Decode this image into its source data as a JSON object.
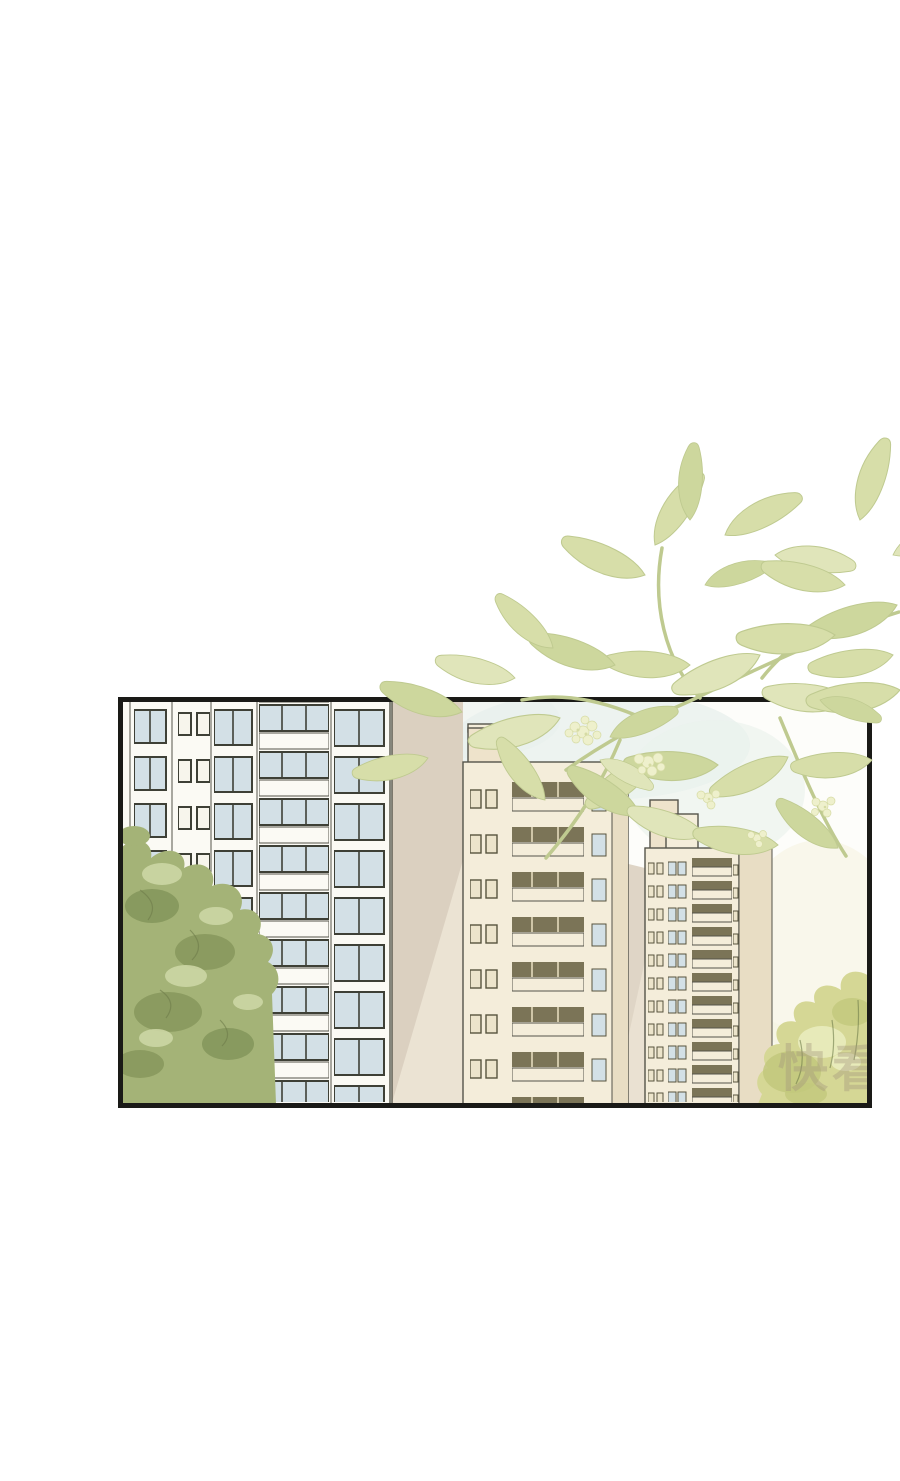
{
  "scene": {
    "type": "comic-panel",
    "watermark": "快看"
  },
  "colors": {
    "page_bg": "#ffffff",
    "panel_border": "#1a1a17",
    "sky": "#fdfdfa",
    "sky_tint": "#e2ece8",
    "sky_tint_warm": "#f4f1dc",
    "outline": "#55544a",
    "wall_white": "#fbfaf4",
    "wall_cream": "#f4edda",
    "wall_cream_dark": "#e8ddc4",
    "wall_tan": "#dbd0c0",
    "wall_tan_light": "#ece4d5",
    "penthouse": "#eee3cb",
    "window_blue": "#d3e0e6",
    "window_white": "#f7f5ec",
    "window_frame": "#3e4036",
    "window_cream": "#ece4cb",
    "window_cream_frame": "#57543e",
    "band_dark": "#7b7457",
    "railing_tan": "#c9b98e",
    "railing_brown": "#8a7b54",
    "railing_slat_dark": "#5c5c44",
    "railing_base_dark": "#a9a685",
    "leaf": "#d7dea9",
    "leaf_b": "#cdd79d",
    "leaf_c": "#e0e5ba",
    "leaf_outline": "#bfca90",
    "flower": "#eef0cc",
    "flower_edge": "#d6dba4",
    "bush": "#a4b377",
    "bush_dark": "#84955a",
    "bush_light": "#ccd6a4",
    "bush_edge": "#6e7c49",
    "foliage": "#d5d795",
    "foliage_dark": "#c2c87c",
    "foliage_light": "#e9ecbc",
    "watermark": "#a2947c"
  }
}
